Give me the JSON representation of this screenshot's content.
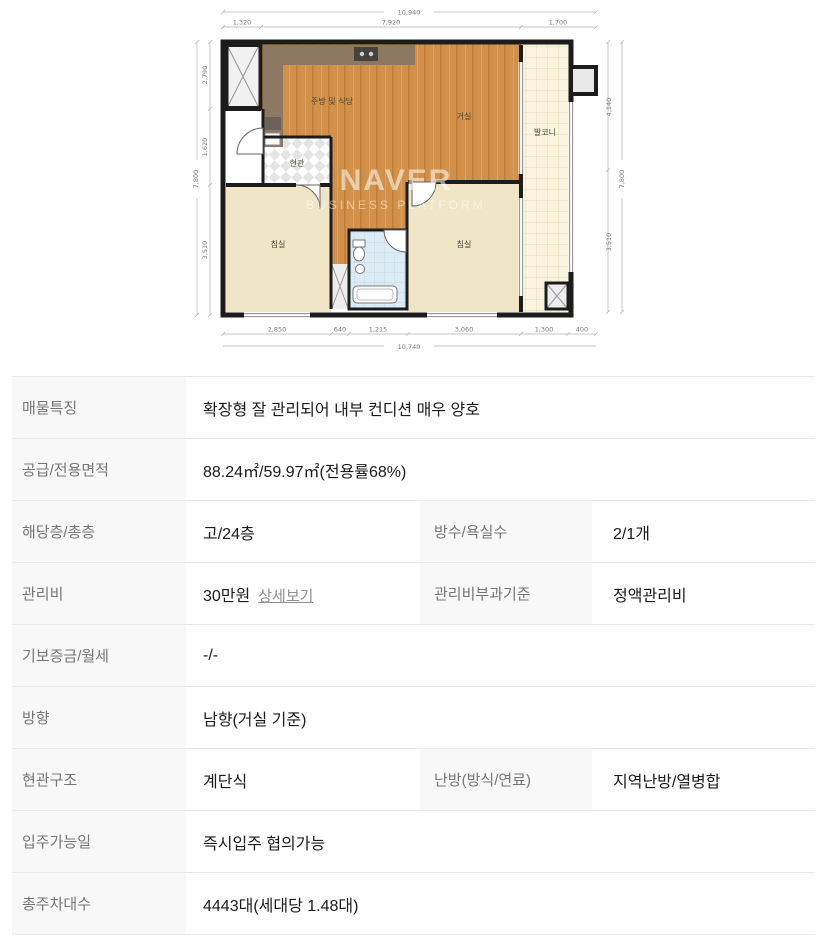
{
  "floor_plan": {
    "watermark": {
      "brand": "NAVER",
      "subtitle": "BUSINESS PLATFORM"
    },
    "rooms": {
      "kitchen": "주방 및 식당",
      "living": "거실",
      "balcony": "발코니",
      "entrance": "현관",
      "bedroom_left": "침실",
      "bedroom_right": "침실"
    },
    "dimensions": {
      "top_total": "10,940",
      "top_segments": [
        "1,320",
        "7,920",
        "1,700"
      ],
      "bottom_segments": [
        "2,850",
        "640",
        "1,215",
        "3,060",
        "1,300",
        "400"
      ],
      "bottom_total": "10,740",
      "left_segments": [
        "2,790",
        "1,620",
        "3,510"
      ],
      "left_total": "7,800",
      "right_segments": [
        "4,140",
        "3,510"
      ],
      "right_total": "7,800"
    }
  },
  "details_table": {
    "rows": [
      {
        "label": "매물특징",
        "value": "확장형 잘 관리되어 내부 컨디션 매우 양호"
      },
      {
        "label": "공급/전용면적",
        "value": "88.24㎡/59.97㎡(전용률68%)"
      },
      {
        "label": "해당층/총층",
        "value": "고/24층",
        "label2": "방수/욕실수",
        "value2": "2/1개"
      },
      {
        "label": "관리비",
        "value": "30만원",
        "link_label": "상세보기",
        "label2": "관리비부과기준",
        "value2": "정액관리비"
      },
      {
        "label": "기보증금/월세",
        "value": "-/-"
      },
      {
        "label": "방향",
        "value": "남향(거실 기준)"
      },
      {
        "label": "현관구조",
        "value": "계단식",
        "label2": "난방(방식/연료)",
        "value2": "지역난방/열병합"
      },
      {
        "label": "입주가능일",
        "value": "즉시입주 협의가능"
      },
      {
        "label": "총주차대수",
        "value": "4443대(세대당 1.48대)"
      }
    ]
  }
}
